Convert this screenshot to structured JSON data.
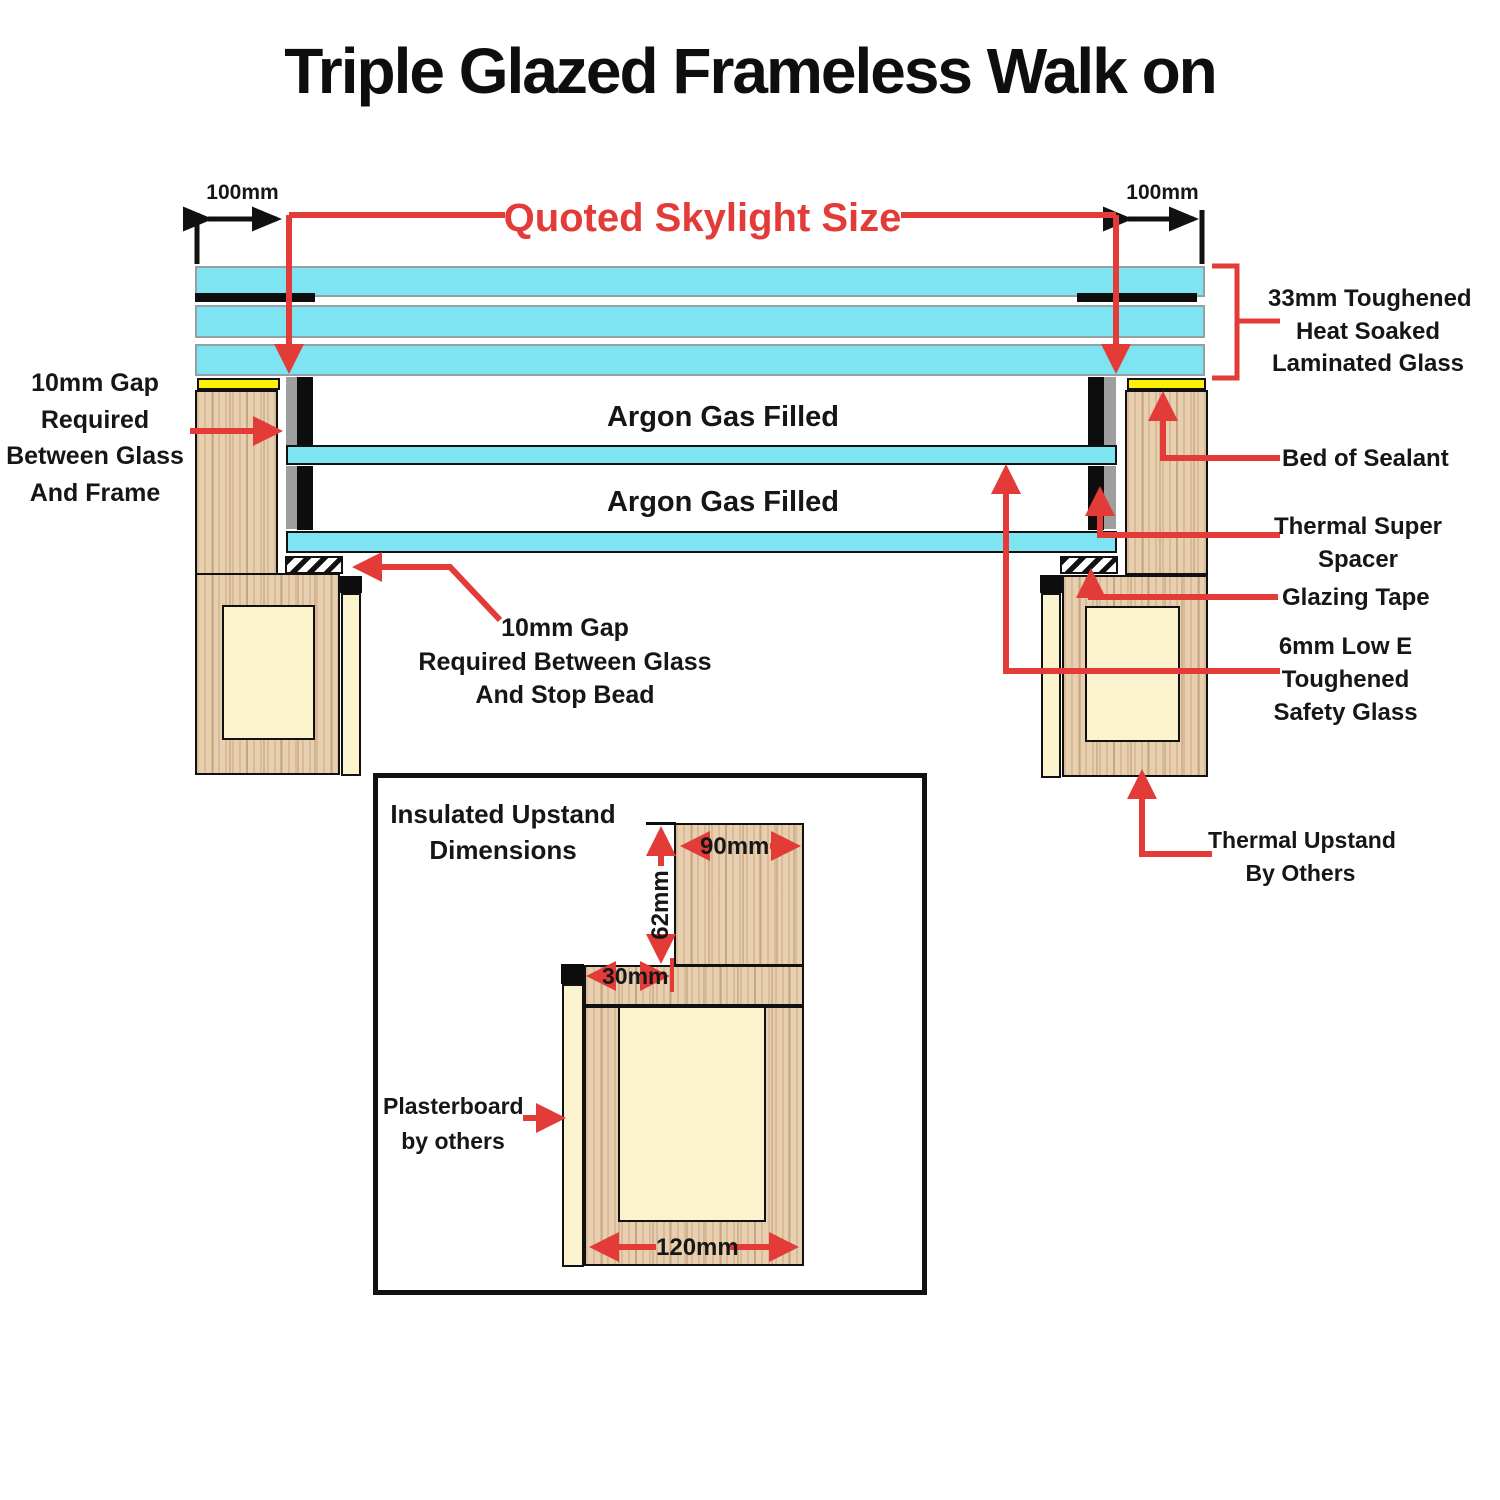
{
  "header": {
    "title": "Triple Glazed Frameless Walk on"
  },
  "colors": {
    "glass_cyan": "#7FE4F1",
    "annotation_red": "#E23B38",
    "wood_tan": "#E8CFB0",
    "insulation_cream": "#FBF2CE",
    "sealant_yellow": "#FFF104",
    "line_black": "#111111"
  },
  "dimensions": {
    "left_overhang": "100mm",
    "right_overhang": "100mm",
    "quoted_size": "Quoted Skylight Size",
    "inset_top_width": "90mm",
    "inset_riser_height": "62mm",
    "inset_step_width": "30mm",
    "inset_base_width": "120mm"
  },
  "glazing": {
    "argon_top": "Argon Gas Filled",
    "argon_bottom": "Argon Gas Filled"
  },
  "callouts": {
    "gap_frame": [
      "10mm Gap",
      "Required",
      "Between Glass",
      "And Frame"
    ],
    "gap_stop_bead": [
      "10mm Gap",
      "Required Between Glass",
      "And Stop Bead"
    ],
    "laminated_glass": [
      "33mm Toughened",
      "Heat Soaked",
      "Laminated Glass"
    ],
    "bed_of_sealant": "Bed of Sealant",
    "thermal_spacer": [
      "Thermal Super",
      "Spacer"
    ],
    "glazing_tape": "Glazing Tape",
    "low_e_glass": [
      "6mm Low E",
      "Toughened",
      "Safety Glass"
    ],
    "thermal_upstand": [
      "Thermal Upstand",
      "By Others"
    ],
    "plasterboard": [
      "Plasterboard",
      "by others"
    ]
  },
  "inset": {
    "title": [
      "Insulated Upstand",
      "Dimensions"
    ]
  }
}
